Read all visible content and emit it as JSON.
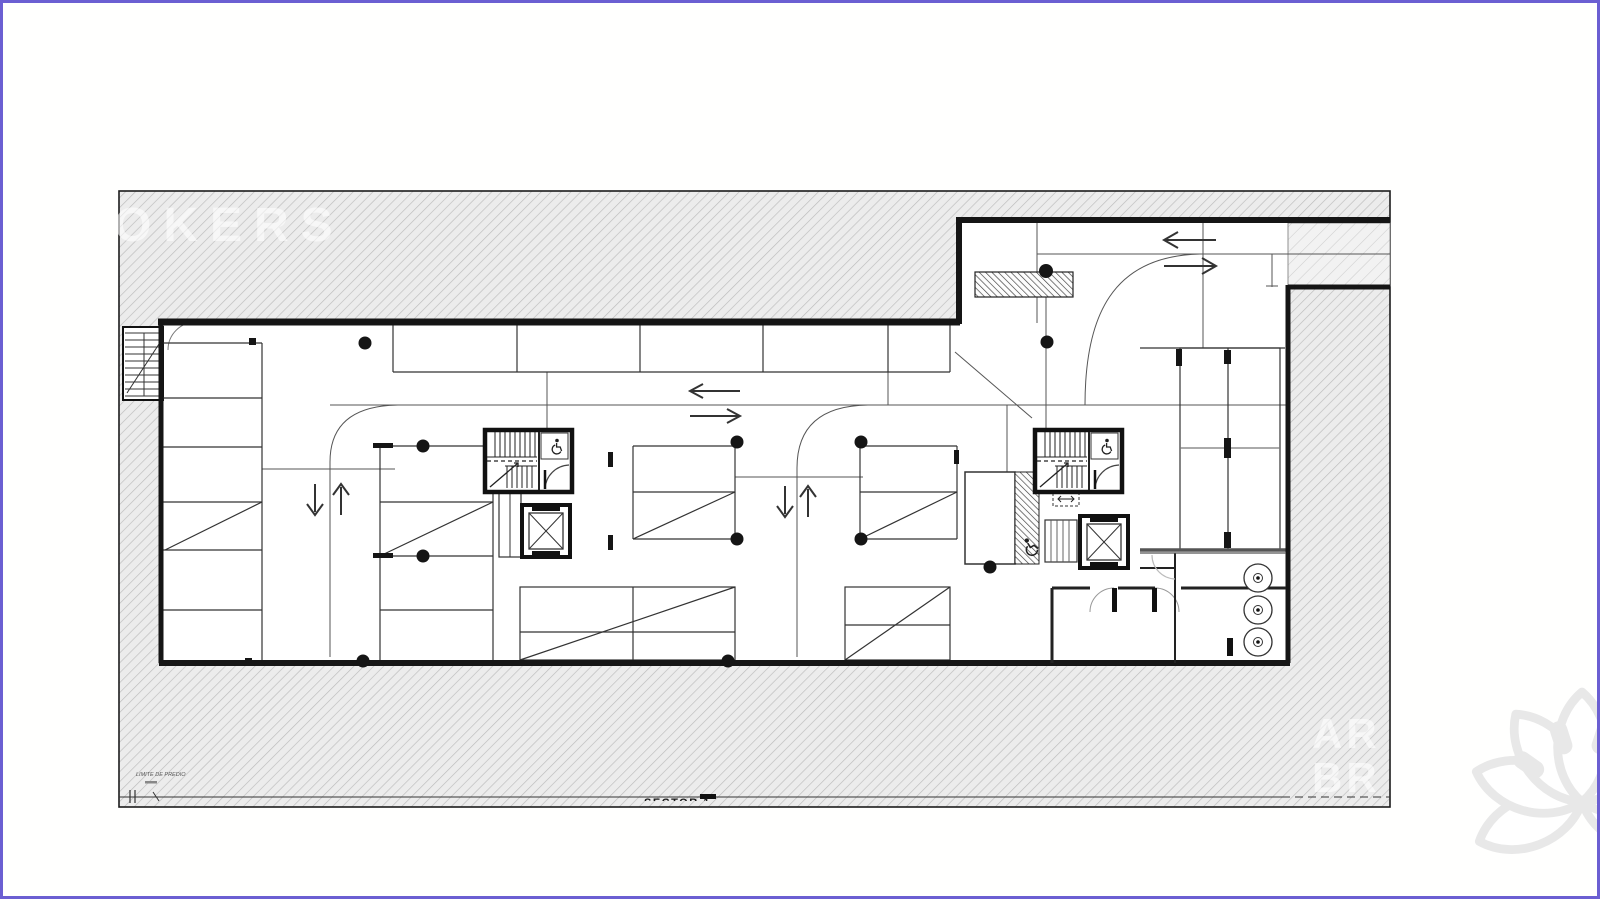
{
  "page": {
    "border_color": "#6b5fd2",
    "background_color": "#ffffff"
  },
  "plan": {
    "kind": "basement parking floor plan",
    "watermark_top_left": "OKERS",
    "watermark_bottom_right_line1": "AR",
    "watermark_bottom_right_line2": "BR",
    "property_line_label": "LIMITE DE PREDIO",
    "sector_label": "SECTOR 1",
    "colors": {
      "site_hatch_line": "#bcbcbc",
      "sidewalk_hatch_line": "#cdcdcd",
      "wall": "#151515",
      "drive_line": "#555555",
      "ramp_hatch": "#3a3a3a",
      "logo_gray": "#e8e8e8"
    },
    "icons": [
      "wheelchair-icon",
      "flower-logo",
      "direction-arrow"
    ],
    "arrows": {
      "street_entry": [
        "exit-left",
        "enter-right"
      ],
      "main_aisle": [
        "left",
        "right"
      ],
      "ramp_lane_1": [
        "down",
        "up"
      ],
      "ramp_lane_2": [
        "down",
        "up"
      ]
    },
    "counts": {
      "stair_cores": 2,
      "elevators": 2,
      "ventilation_circles": 3
    }
  }
}
